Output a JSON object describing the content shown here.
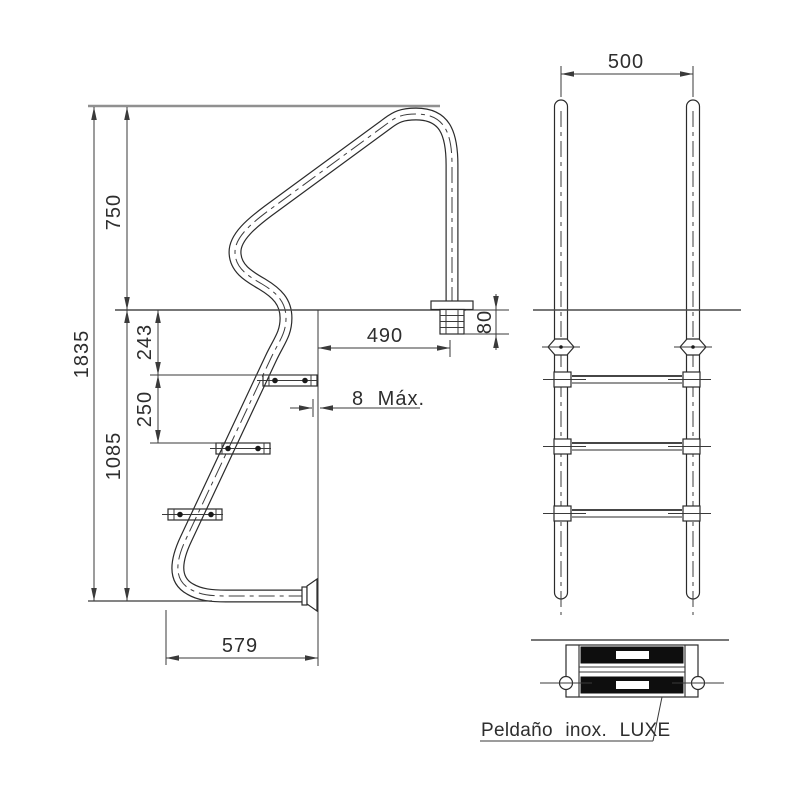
{
  "colors": {
    "line": "#2b2b2b",
    "dimension": "#3a3a3a",
    "reference": "#909090",
    "tread_fill": "#0e0e0e",
    "background": "#ffffff"
  },
  "side_view": {
    "dims": {
      "total_height": "1835",
      "handrail_above_deck": "750",
      "deck_to_first_step": "243",
      "step_spacing": "250",
      "deck_to_bottom": "1085",
      "handrail_anchor_offset": "490",
      "anchor_body_height": "80",
      "wall_gap_max": "8 Máx.",
      "bottom_tube_reach": "579"
    }
  },
  "front_view": {
    "dims": {
      "handrail_spacing": "500"
    }
  },
  "step_detail": {
    "caption": "Peldaño inox. LUXE"
  }
}
